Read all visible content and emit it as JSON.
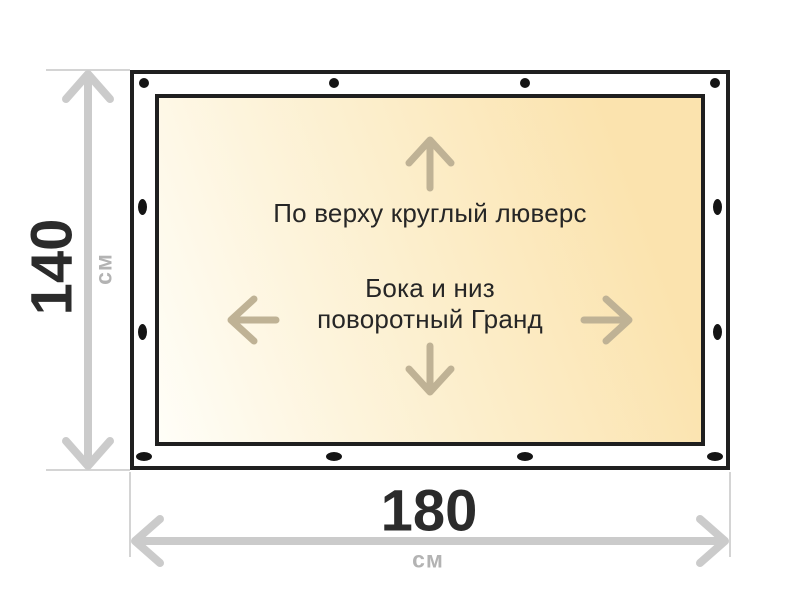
{
  "figure": {
    "type": "banner-size-diagram",
    "labels": {
      "top_note": "По верху круглый люверс",
      "center_note_line1": "Бока и низ",
      "center_note_line2": "поворотный Гранд"
    },
    "dimensions": {
      "height": {
        "value": "140",
        "unit": "см"
      },
      "width": {
        "value": "180",
        "unit": "см"
      }
    },
    "colors": {
      "border": "#1f1f1f",
      "grommet": "#141414",
      "banner_gradient_start": "#fffef8",
      "banner_gradient_end": "#fbe3ae",
      "direction_arrow": "#bfb295",
      "dimension_arrow": "#cbcbcb",
      "extension_line": "#d4d4d4",
      "dimension_number": "#2b2b2b",
      "dimension_unit": "#b3b3b3",
      "note_text": "#262626"
    },
    "grommets": [
      {
        "shape": "round",
        "x": 144,
        "y": 83,
        "w": 10,
        "h": 10
      },
      {
        "shape": "round",
        "x": 334,
        "y": 83,
        "w": 10,
        "h": 10
      },
      {
        "shape": "round",
        "x": 525,
        "y": 83,
        "w": 10,
        "h": 10
      },
      {
        "shape": "round",
        "x": 715,
        "y": 83,
        "w": 10,
        "h": 10
      },
      {
        "shape": "oval-horizontal",
        "x": 144,
        "y": 456,
        "w": 16,
        "h": 9
      },
      {
        "shape": "oval-horizontal",
        "x": 334,
        "y": 456,
        "w": 16,
        "h": 9
      },
      {
        "shape": "oval-horizontal",
        "x": 525,
        "y": 456,
        "w": 16,
        "h": 9
      },
      {
        "shape": "oval-horizontal",
        "x": 715,
        "y": 456,
        "w": 16,
        "h": 9
      },
      {
        "shape": "oval-vertical",
        "x": 142,
        "y": 207,
        "w": 9,
        "h": 16
      },
      {
        "shape": "oval-vertical",
        "x": 142,
        "y": 332,
        "w": 9,
        "h": 16
      },
      {
        "shape": "oval-vertical",
        "x": 717,
        "y": 207,
        "w": 9,
        "h": 16
      },
      {
        "shape": "oval-vertical",
        "x": 717,
        "y": 332,
        "w": 9,
        "h": 16
      }
    ],
    "direction_arrows": [
      "up",
      "left",
      "right",
      "down"
    ]
  }
}
